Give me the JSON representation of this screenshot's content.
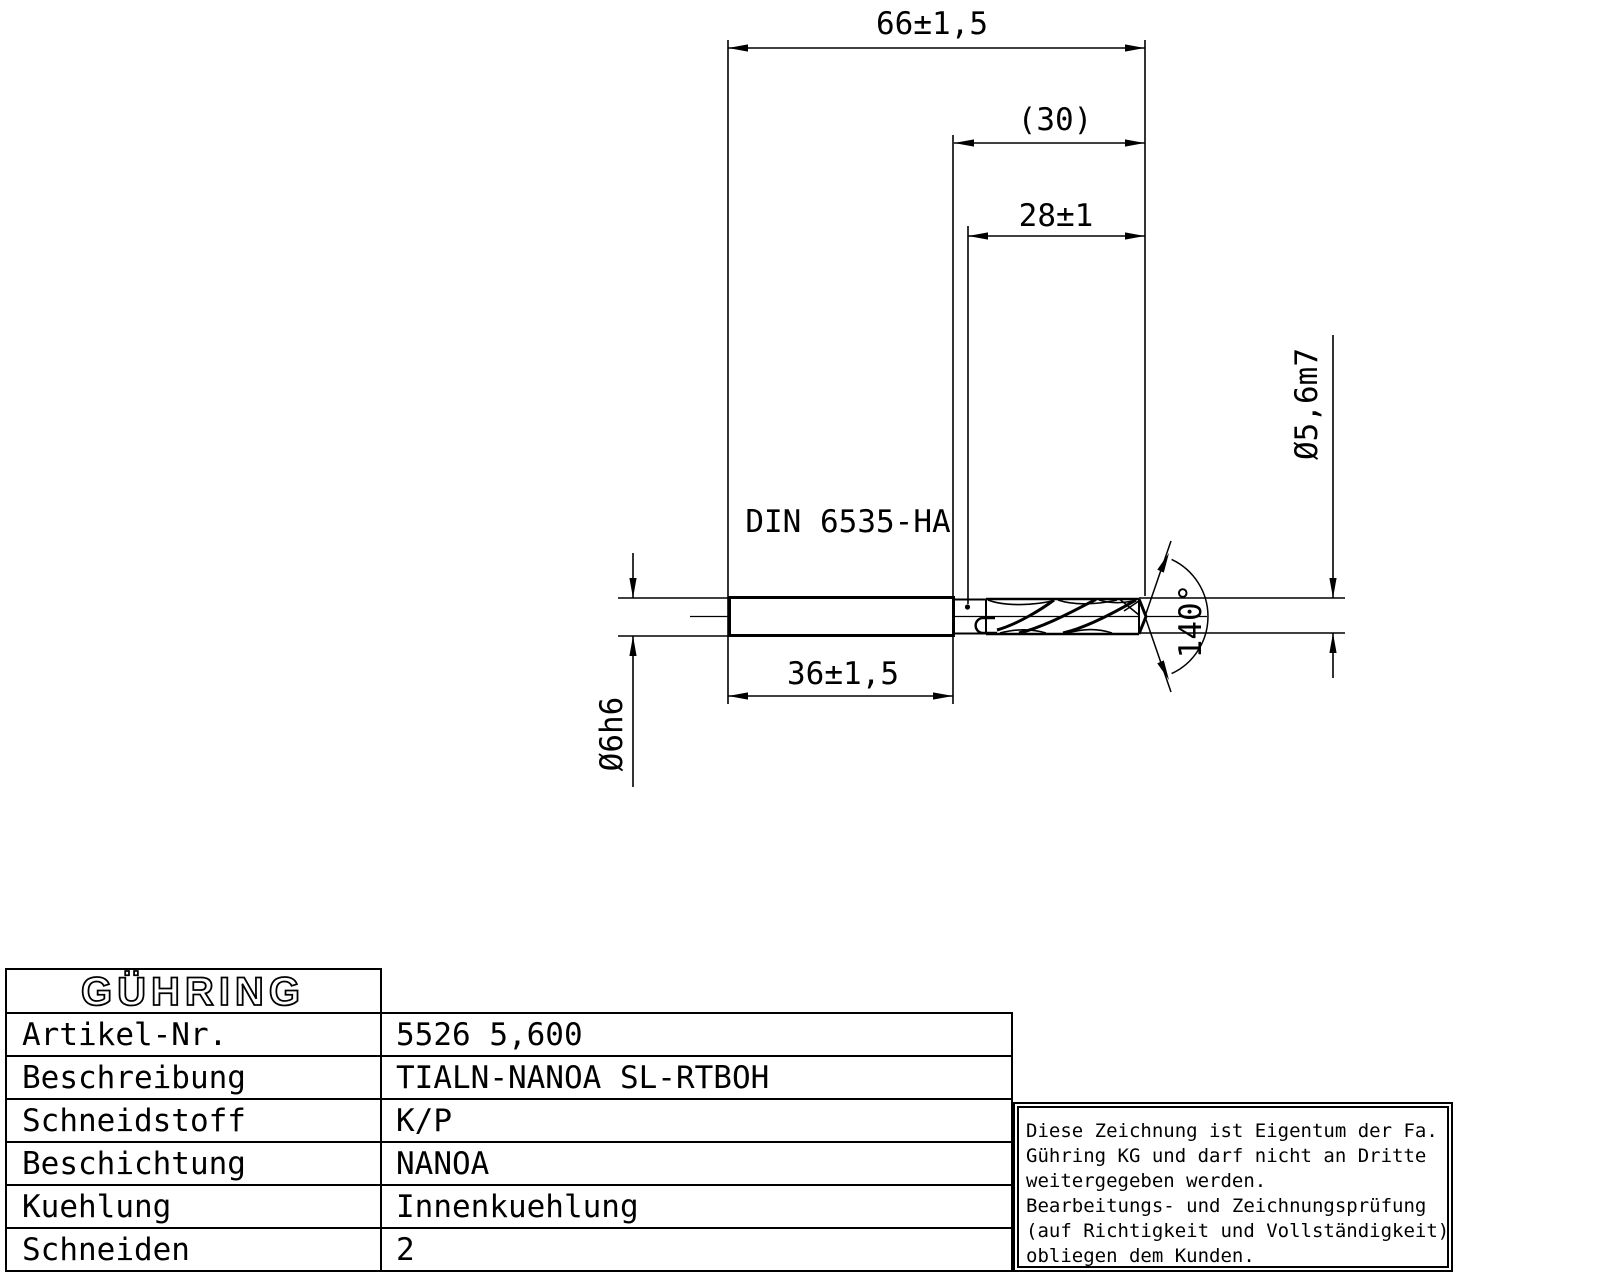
{
  "drawing": {
    "dims": {
      "overall_length": "66±1,5",
      "step_ref": "(30)",
      "flute_length": "28±1",
      "shank_length": "36±1,5",
      "shank_diameter": "Ø6h6",
      "tool_diameter": "Ø5,6m7",
      "point_angle": "140°",
      "shank_standard": "DIN 6535-HA"
    }
  },
  "table": {
    "brand": "GÜHRING",
    "rows": [
      {
        "label": "Artikel-Nr.",
        "value": "5526 5,600"
      },
      {
        "label": "Beschreibung",
        "value": "TIALN-NANOA SL-RTBOH"
      },
      {
        "label": "Schneidstoff",
        "value": "K/P"
      },
      {
        "label": "Beschichtung",
        "value": "NANOA"
      },
      {
        "label": "Kuehlung",
        "value": "Innenkuehlung"
      },
      {
        "label": "Schneiden",
        "value": "2"
      }
    ]
  },
  "notice": {
    "lines": [
      "Diese Zeichnung ist Eigentum der Fa.",
      "Gühring KG und darf nicht an Dritte",
      "weitergegeben werden.",
      "Bearbeitungs- und Zeichnungsprüfung",
      "(auf Richtigkeit und Vollständigkeit)",
      "obliegen dem Kunden."
    ]
  },
  "colors": {
    "ink": "#000000",
    "paper": "#ffffff"
  }
}
